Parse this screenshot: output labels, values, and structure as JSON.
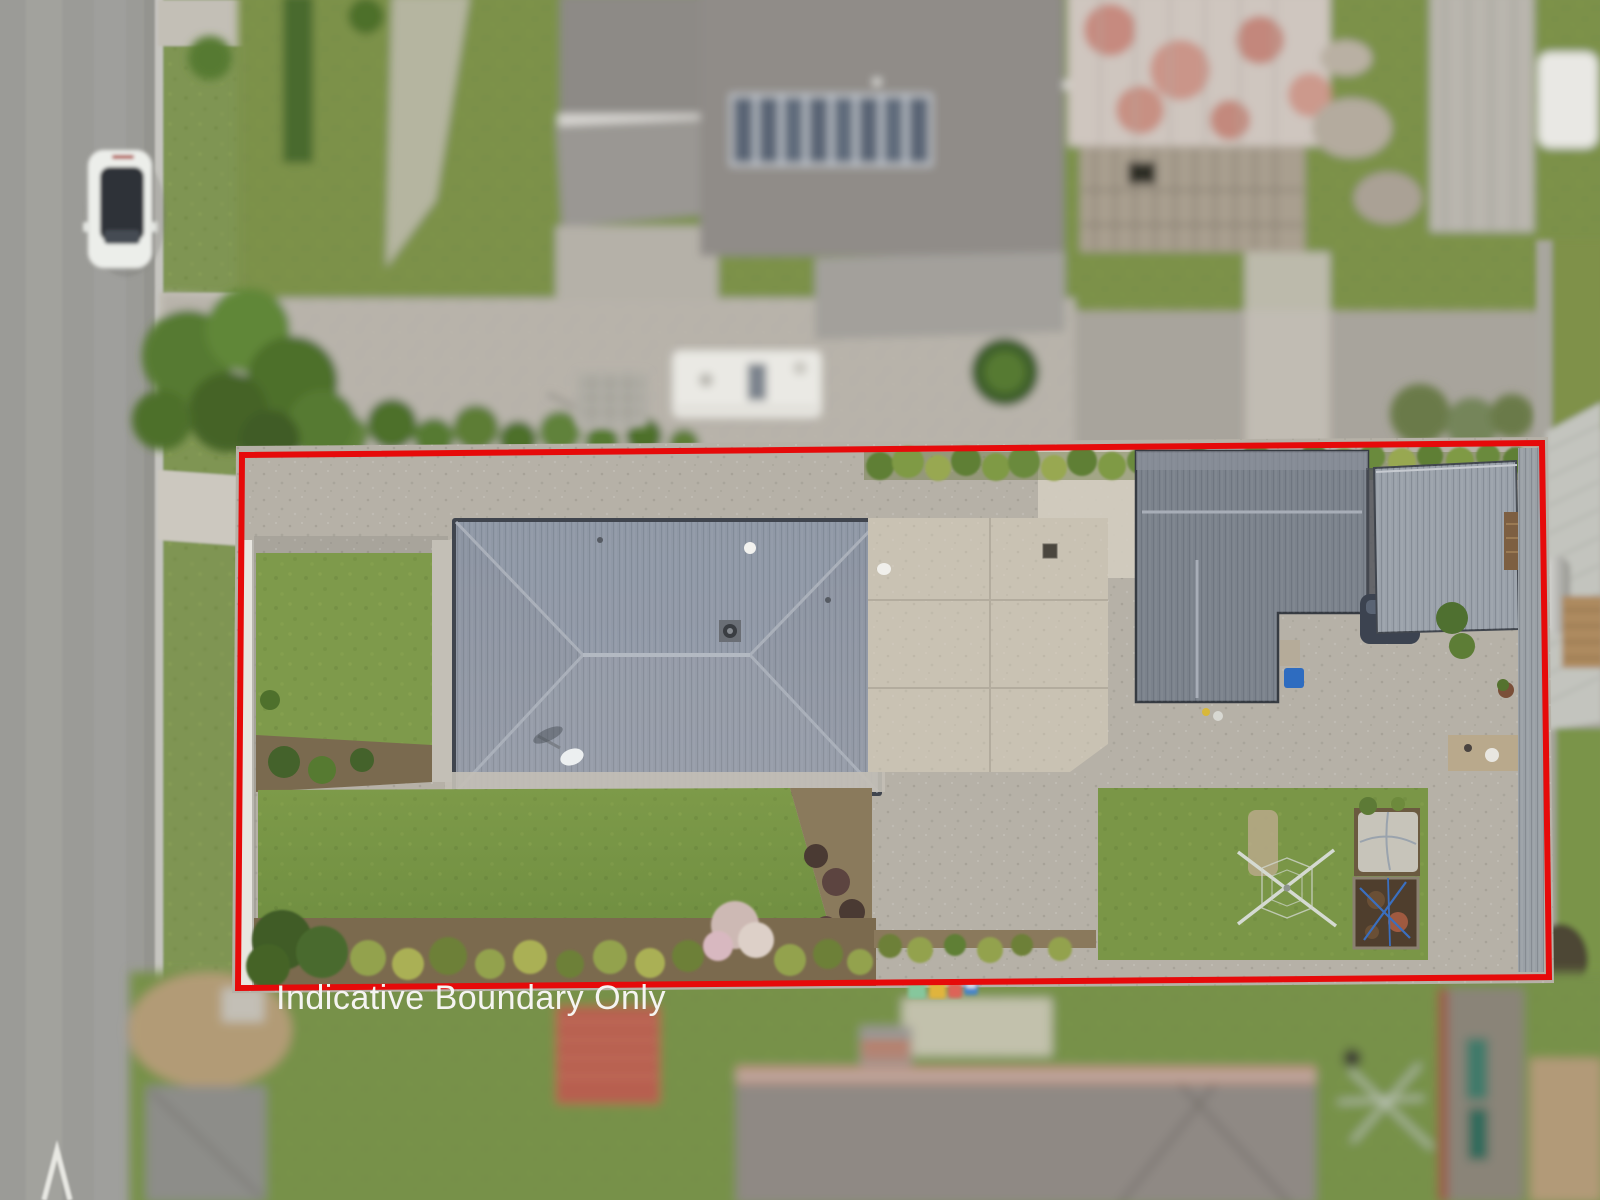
{
  "scene": {
    "type": "aerial-drone-photo",
    "caption": {
      "text": "Indicative Boundary Only",
      "color": "#f5f4f1"
    },
    "boundary": {
      "color": "#e60a0a",
      "stroke_width": 6,
      "points": "242,455 1542,443 1549,977 238,988"
    },
    "palette": {
      "road": "#9b9b97",
      "curb": "#c6c5c0",
      "berm_grass": "#7f9552",
      "footpath": "#c6c2b9",
      "lawn": "#7d9a49",
      "lawn_dark": "#69883c",
      "gravel": "#b6b1a7",
      "concrete_pad": "#c9c2b3",
      "house_roof": "#8b93a0",
      "dwelling_roof": "#7b828c",
      "garage_roof": "#9aa1ab",
      "top_house_roof": "#908c88",
      "barn_rust": "#c08073",
      "hedge": "#5a7a33",
      "tree": "#567a31",
      "soil": "#8a7a5c",
      "dirt": "#b29b76",
      "car_white": "#eceeea",
      "bin_green": "#86c79c",
      "bin_yellow": "#e0b43c",
      "bin_red": "#dd6458",
      "bin_blue": "#4a86c8",
      "clothesline": "#d5dad2",
      "bottom_roof": "#8f8984",
      "ridge_orange": "#c4714e",
      "caravan_white": "#eae9e4",
      "solar_panel": "#5a6574"
    }
  }
}
